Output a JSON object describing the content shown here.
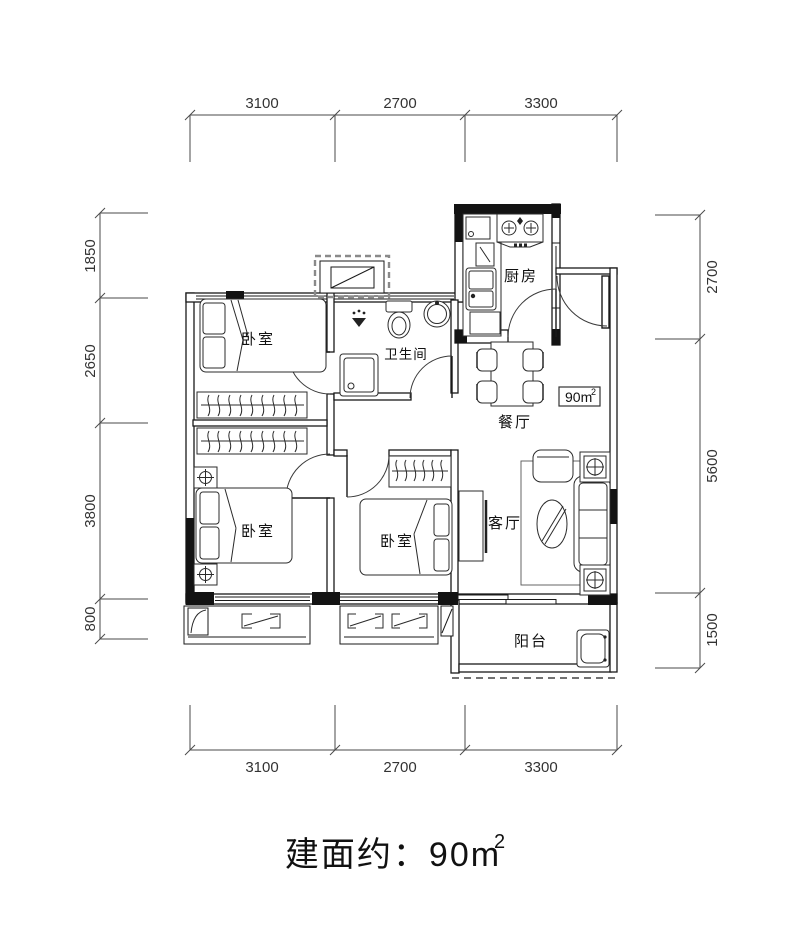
{
  "plan": {
    "rooms": [
      {
        "id": "bedroom-1",
        "label": "卧室"
      },
      {
        "id": "bedroom-2",
        "label": "卧室"
      },
      {
        "id": "bedroom-3",
        "label": "卧室"
      },
      {
        "id": "bathroom",
        "label": "卫生间"
      },
      {
        "id": "kitchen",
        "label": "厨房"
      },
      {
        "id": "dining",
        "label": "餐厅"
      },
      {
        "id": "living",
        "label": "客厅"
      },
      {
        "id": "balcony",
        "label": "阳台"
      }
    ],
    "area_badge": {
      "value": "90m",
      "sup": "2"
    },
    "dimensions": {
      "top": [
        "3100",
        "2700",
        "3300"
      ],
      "bottom": [
        "3100",
        "2700",
        "3300"
      ],
      "left": [
        "1850",
        "2650",
        "3800",
        "800"
      ],
      "right": [
        "2700",
        "5600",
        "1500"
      ]
    }
  },
  "caption": {
    "text": "建面约：90m",
    "sup": "2"
  },
  "colors": {
    "line": "#1a1a1a",
    "wall_fill": "#131313",
    "background": "#ffffff"
  }
}
